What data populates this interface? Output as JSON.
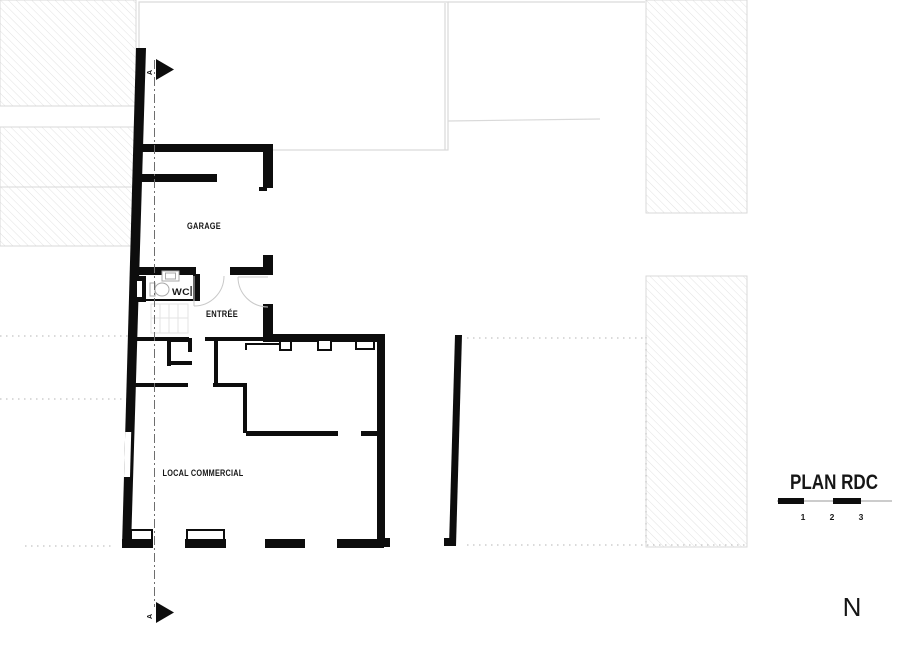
{
  "drawing": {
    "title": "PLAN RDC",
    "north_label": "N",
    "section_marker_top": "A",
    "section_marker_bottom": "A",
    "rooms": {
      "garage": "GARAGE",
      "wc": "WC",
      "entree": "ENTRÉE",
      "local_commercial": "LOCAL COMMERCIAL"
    },
    "scale_bar": {
      "tick_1": "1",
      "tick_2": "2",
      "tick_3": "3"
    },
    "colors": {
      "wall": "#0d0d0d",
      "hatch_line": "#e2e2e2",
      "neighbor_outline": "#d9d9d9",
      "section_line": "#6e6e6e",
      "dotted_line": "#b5b5b5",
      "door_arc": "#c9c9c9",
      "fixture_outline": "#a8a8a8"
    }
  }
}
